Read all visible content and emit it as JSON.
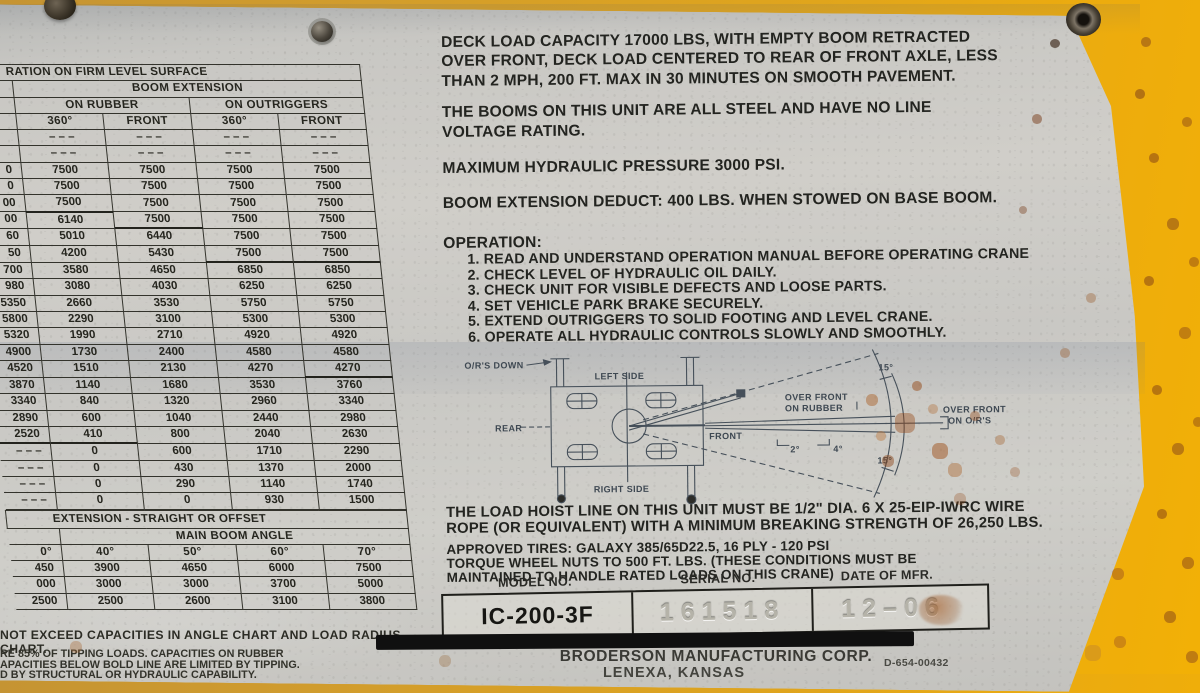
{
  "left_chart": {
    "surface_title": "RATION ON FIRM LEVEL SURFACE",
    "boom_extension_header": "BOOM EXTENSION",
    "group_on_rubber": "ON RUBBER",
    "group_on_outriggers": "ON OUTRIGGERS",
    "col_headers": [
      "360°",
      "FRONT",
      "360°",
      "FRONT"
    ],
    "rows": [
      [
        "",
        "– – –",
        "– – –",
        "– – –",
        "– – –"
      ],
      [
        "",
        "– – –",
        "– – –",
        "– – –",
        "– – –"
      ],
      [
        "0",
        "7500",
        "7500",
        "7500",
        "7500"
      ],
      [
        "0",
        "7500",
        "7500",
        "7500",
        "7500"
      ],
      [
        "00",
        "7500",
        "7500",
        "7500",
        "7500"
      ],
      [
        "00",
        "6140",
        "7500",
        "7500",
        "7500"
      ],
      [
        "60",
        "5010",
        "6440",
        "7500",
        "7500"
      ],
      [
        "50",
        "4200",
        "5430",
        "7500",
        "7500"
      ],
      [
        "700",
        "3580",
        "4650",
        "6850",
        "6850"
      ],
      [
        "980",
        "3080",
        "4030",
        "6250",
        "6250"
      ],
      [
        "5350",
        "2660",
        "3530",
        "5750",
        "5750"
      ],
      [
        "5800",
        "2290",
        "3100",
        "5300",
        "5300"
      ],
      [
        "5320",
        "1990",
        "2710",
        "4920",
        "4920"
      ],
      [
        "4900",
        "1730",
        "2400",
        "4580",
        "4580"
      ],
      [
        "4520",
        "1510",
        "2130",
        "4270",
        "4270"
      ],
      [
        "3870",
        "1140",
        "1680",
        "3530",
        "3760"
      ],
      [
        "3340",
        "840",
        "1320",
        "2960",
        "3340"
      ],
      [
        "2890",
        "600",
        "1040",
        "2440",
        "2980"
      ],
      [
        "2520",
        "410",
        "800",
        "2040",
        "2630"
      ],
      [
        "– – –",
        "0",
        "600",
        "1710",
        "2290"
      ],
      [
        "– – –",
        "0",
        "430",
        "1370",
        "2000"
      ],
      [
        "– – –",
        "0",
        "290",
        "1140",
        "1740"
      ],
      [
        "– – –",
        "0",
        "0",
        "930",
        "1500"
      ]
    ],
    "extension_title": "EXTENSION - STRAIGHT OR OFFSET",
    "main_boom_angle": "MAIN BOOM ANGLE",
    "angle_col_headers": [
      "0°",
      "40°",
      "50°",
      "60°",
      "70°"
    ],
    "angle_rows": [
      [
        "450",
        "3900",
        "4650",
        "6000",
        "7500"
      ],
      [
        "000",
        "3000",
        "3000",
        "3700",
        "5000"
      ],
      [
        "2500",
        "2500",
        "2600",
        "3100",
        "3800"
      ]
    ],
    "note_exceed": "NOT EXCEED CAPACITIES IN ANGLE CHART AND LOAD RADIUS CHART.",
    "notes_small": [
      "RE 85% OF TIPPING LOADS. CAPACITIES ON RUBBER",
      "APACITIES BELOW BOLD LINE ARE LIMITED BY TIPPING.",
      "D BY STRUCTURAL OR HYDRAULIC CAPABILITY."
    ]
  },
  "right_panel": {
    "deck_load": [
      "DECK LOAD CAPACITY 17000 LBS, WITH EMPTY BOOM RETRACTED",
      "OVER FRONT, DECK LOAD CENTERED TO REAR OF FRONT AXLE, LESS",
      "THAN 2 MPH, 200 FT. MAX IN 30 MINUTES ON SMOOTH PAVEMENT."
    ],
    "booms_steel": [
      "THE BOOMS ON THIS UNIT ARE ALL STEEL AND HAVE NO LINE",
      "VOLTAGE RATING."
    ],
    "pressure": "MAXIMUM HYDRAULIC PRESSURE 3000 PSI.",
    "deduct": "BOOM EXTENSION DEDUCT: 400 LBS. WHEN STOWED ON BASE BOOM.",
    "operation_title": "OPERATION:",
    "operation_items": [
      "1. READ AND UNDERSTAND OPERATION MANUAL BEFORE OPERATING CRANE",
      "2. CHECK LEVEL OF HYDRAULIC OIL DAILY.",
      "3. CHECK UNIT FOR VISIBLE DEFECTS AND LOOSE PARTS.",
      "4. SET VEHICLE PARK BRAKE SECURELY.",
      "5. EXTEND OUTRIGGERS TO SOLID FOOTING AND LEVEL CRANE.",
      "6. OPERATE ALL HYDRAULIC CONTROLS SLOWLY AND SMOOTHLY."
    ],
    "hoist_line": [
      "THE LOAD HOIST LINE ON THIS UNIT MUST BE 1/2\" DIA. 6 X 25-EIP-IWRC WIRE",
      "ROPE (OR EQUIVALENT) WITH A MINIMUM BREAKING STRENGTH OF 26,250 LBS."
    ],
    "tires": "APPROVED TIRES: GALAXY 385/65D22.5, 16 PLY - 120 PSI",
    "torque": [
      "TORQUE WHEEL NUTS TO 500 FT. LBS.  (THESE CONDITIONS MUST BE",
      "MAINTAINED TO HANDLE RATED LOADS ON THIS CRANE)"
    ]
  },
  "diagram": {
    "ors_down": "O/R'S DOWN",
    "left_side": "LEFT SIDE",
    "right_side": "RIGHT SIDE",
    "rear": "REAR",
    "front": "FRONT",
    "over_front_rubber1": "OVER FRONT",
    "over_front_rubber2": "ON RUBBER",
    "deg2": "2°",
    "deg4": "4°",
    "deg15_top": "15°",
    "deg15_bottom": "15°",
    "over_front_ors1": "OVER FRONT",
    "over_front_ors2": "ON O/R'S"
  },
  "id_plate": {
    "model_label": "MODEL NO.",
    "serial_label": "SERIAL NO.",
    "date_label": "DATE OF MFR.",
    "model": "IC-200-3F",
    "serial": "161518",
    "date": "12–06"
  },
  "footer": {
    "manufacturer": "BRODERSON MANUFACTURING CORP.",
    "city": "LENEXA, KANSAS",
    "part_number": "D-654-00432"
  }
}
